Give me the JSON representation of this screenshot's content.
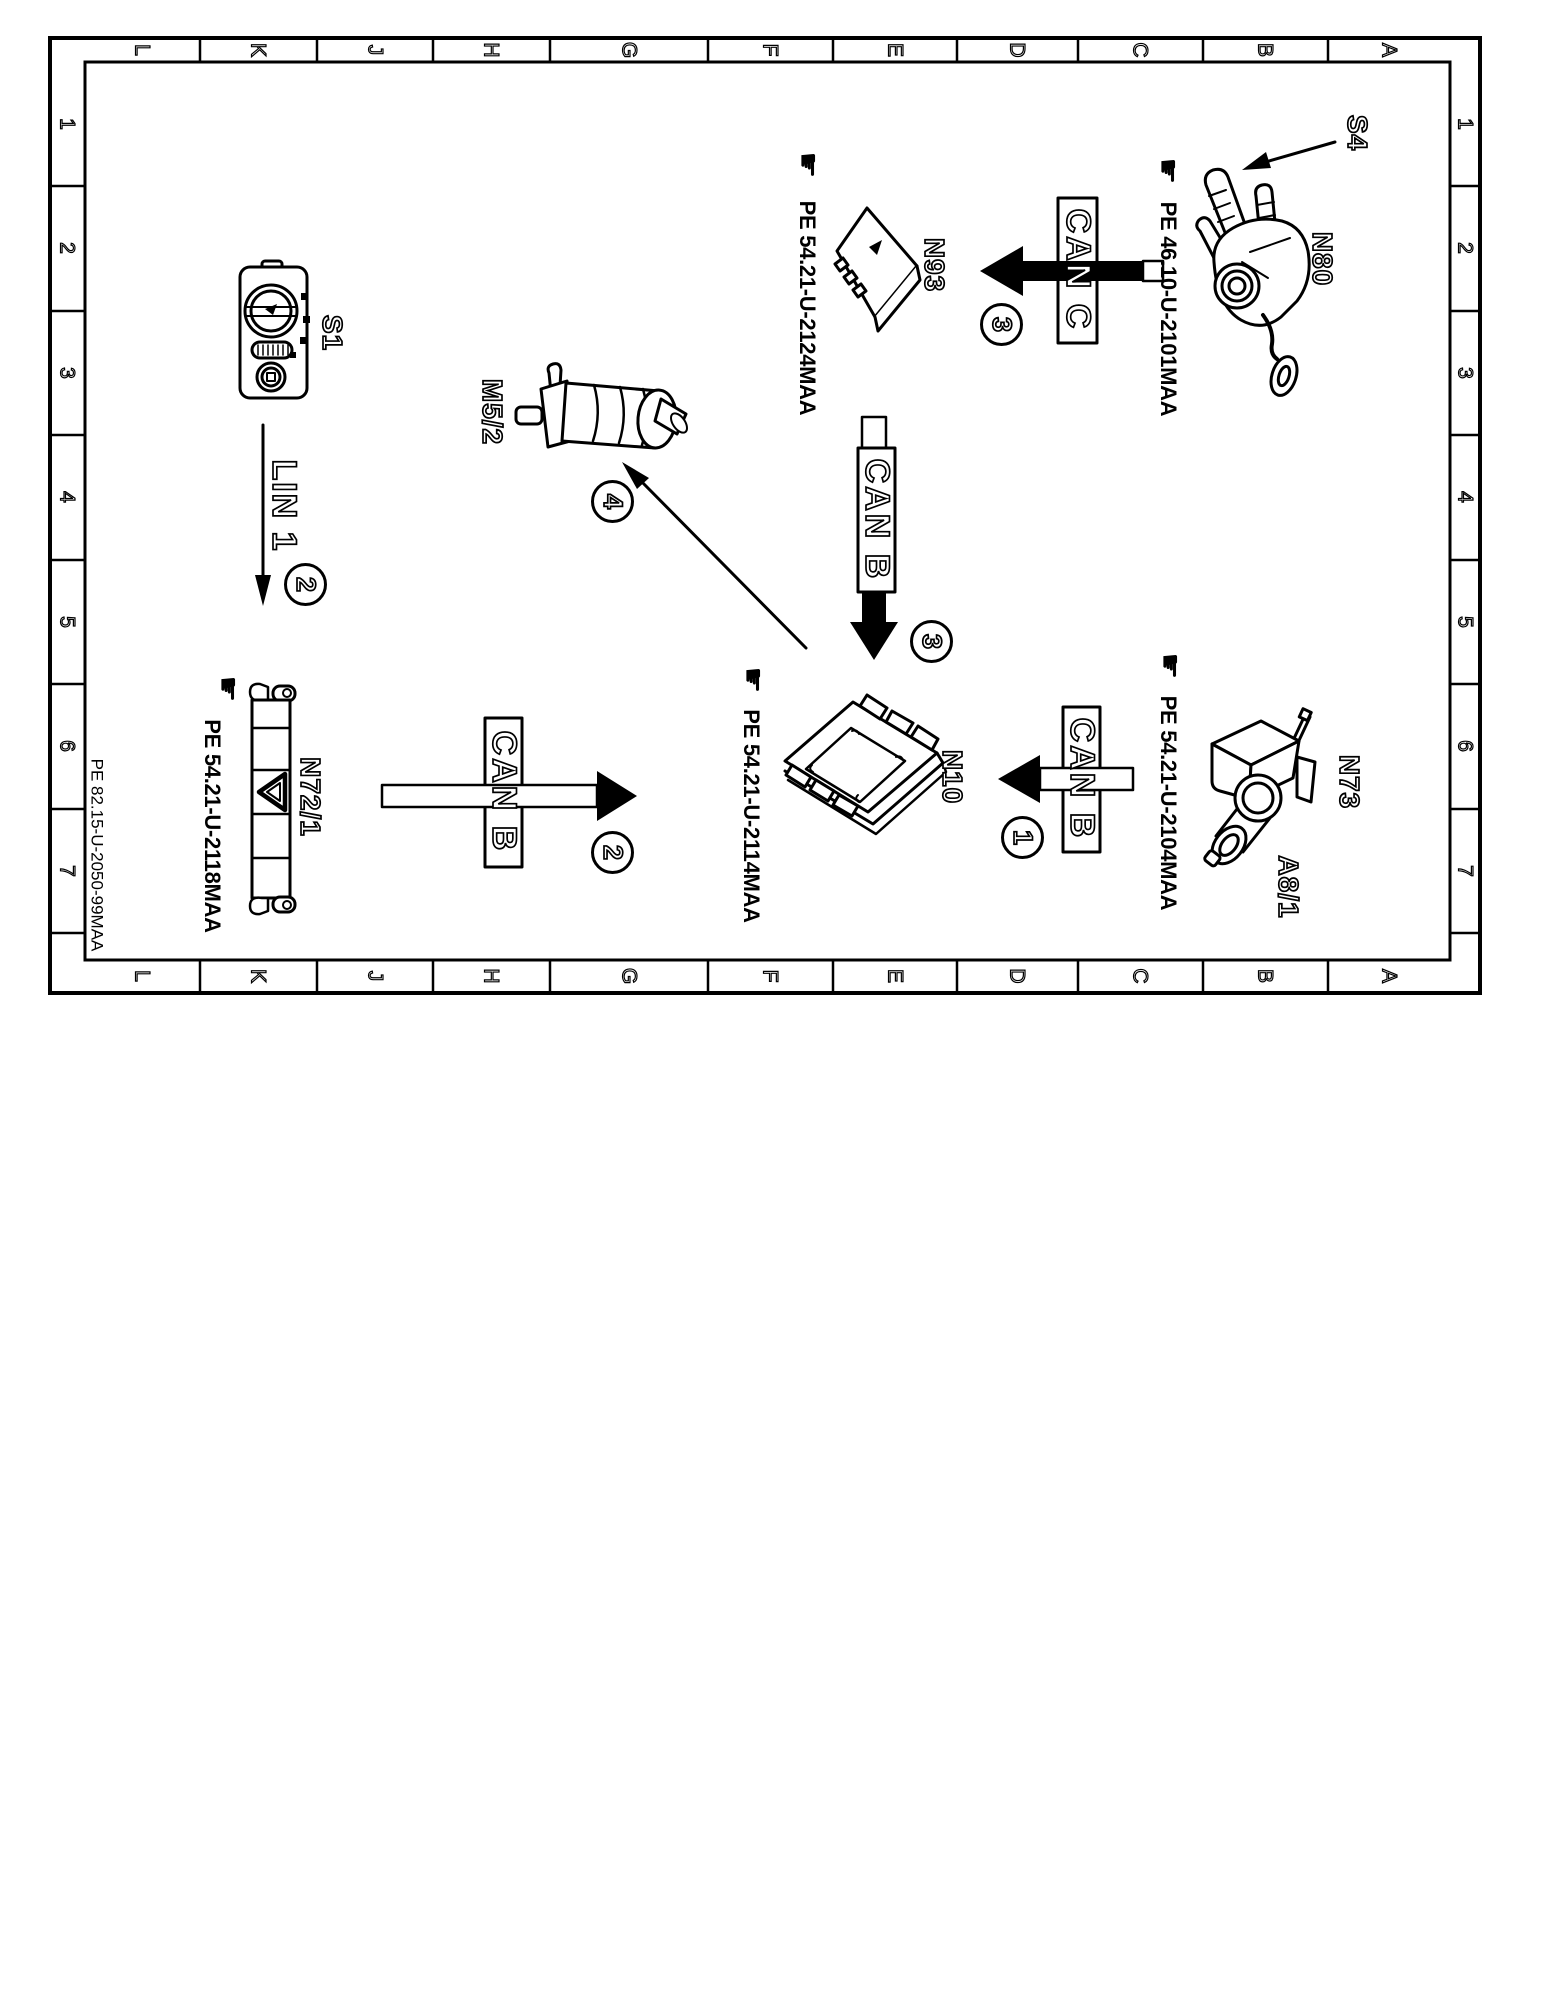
{
  "sheet": {
    "doc_code": "PE 82.15-U-2050-99MAA",
    "grid_columns": [
      "L",
      "K",
      "J",
      "H",
      "G",
      "F",
      "E",
      "D",
      "C",
      "B",
      "A"
    ],
    "grid_rows": [
      "1",
      "2",
      "3",
      "4",
      "5",
      "6",
      "7"
    ]
  },
  "icons": {
    "hand": "☛"
  },
  "components": {
    "s4": {
      "label": "S4"
    },
    "n80": {
      "label": "N80",
      "pe": "PE 46.10-U-2101MAA"
    },
    "n93": {
      "label": "N93",
      "pe": "PE 54.21-U-2124MAA"
    },
    "m5_2": {
      "label": "M5/2"
    },
    "s1": {
      "label": "S1"
    },
    "n72_1": {
      "label": "N72/1",
      "pe": "PE 54.21-U-2118MAA"
    },
    "n10": {
      "label": "N10",
      "pe": "PE 54.21-U-2114MAA"
    },
    "n73": {
      "label": "N73",
      "connector": "A8/1",
      "pe": "PE 54.21-U-2104MAA"
    }
  },
  "buses": {
    "can_c": {
      "label": "CAN C",
      "step": "3"
    },
    "can_b_center": {
      "label": "CAN B",
      "step": "3"
    },
    "can_b_left": {
      "label": "CAN B",
      "step": "2"
    },
    "can_b_right": {
      "label": "CAN B",
      "step": "1"
    },
    "lin_1": {
      "label": "LIN 1",
      "step": "2"
    },
    "pump_arrow": {
      "step": "4"
    }
  }
}
